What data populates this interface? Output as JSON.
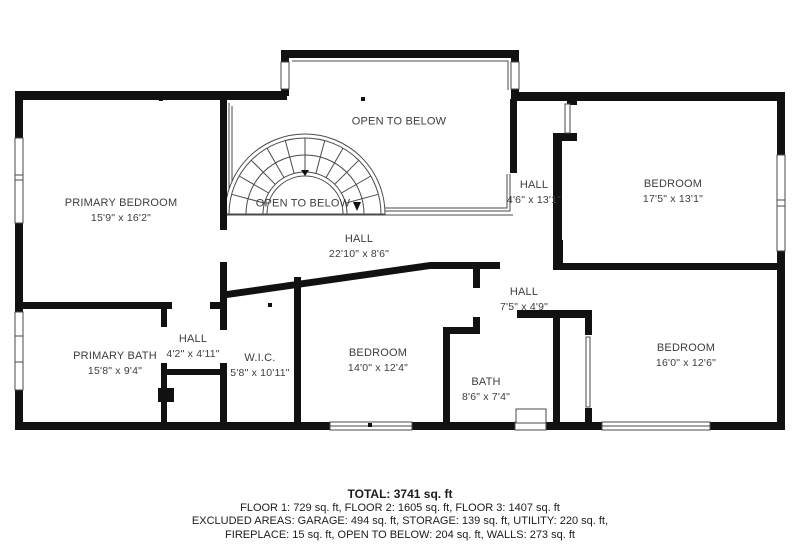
{
  "plan": {
    "rooms": [
      {
        "name": "OPEN TO BELOW",
        "dims": ""
      },
      {
        "name": "PRIMARY BEDROOM",
        "dims": "15'9\" x 16'2\""
      },
      {
        "name": "OPEN TO BELOW",
        "dims": ""
      },
      {
        "name": "HALL",
        "dims": "22'10\" x 8'6\""
      },
      {
        "name": "HALL",
        "dims": "4'6\" x 13'1\""
      },
      {
        "name": "BEDROOM",
        "dims": "17'5\" x 13'1\""
      },
      {
        "name": "PRIMARY BATH",
        "dims": "15'8\" x 9'4\""
      },
      {
        "name": "HALL",
        "dims": "4'2\" x 4'11\""
      },
      {
        "name": "W.I.C.",
        "dims": "5'8\" x 10'11\""
      },
      {
        "name": "BEDROOM",
        "dims": "14'0\" x 12'4\""
      },
      {
        "name": "BATH",
        "dims": "8'6\" x 7'4\""
      },
      {
        "name": "HALL",
        "dims": "7'5\" x 4'9\""
      },
      {
        "name": "BEDROOM",
        "dims": "16'0\" x 12'6\""
      }
    ],
    "wall_color": "#111111",
    "line_color": "#4a4a4a"
  },
  "footer": {
    "total": "TOTAL: 3741 sq. ft",
    "floors": "FLOOR 1: 729 sq. ft, FLOOR 2: 1605 sq. ft, FLOOR 3: 1407 sq. ft",
    "excluded": "EXCLUDED AREAS: GARAGE: 494 sq. ft, STORAGE: 139 sq. ft, UTILITY: 220 sq. ft,",
    "excluded2": "FIREPLACE: 15 sq. ft, OPEN TO BELOW: 204 sq. ft, WALLS: 273 sq. ft"
  }
}
